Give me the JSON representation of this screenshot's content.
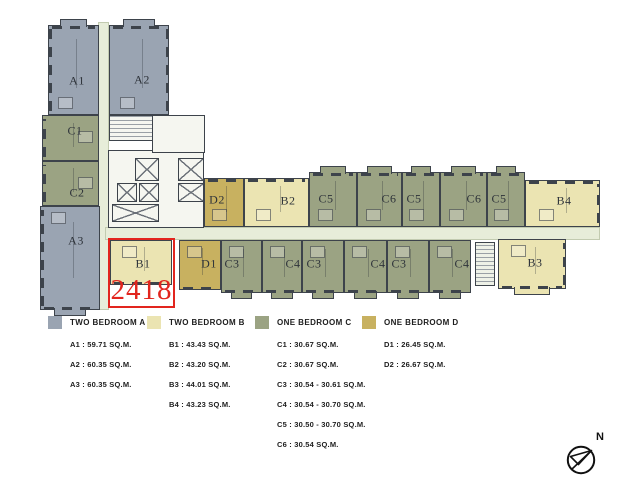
{
  "plan": {
    "wall_color": "#3d434b",
    "unit_colors": {
      "A": "#9aa4b2",
      "B": "#ebe4b2",
      "C": "#9ba383",
      "D": "#c8b160"
    },
    "corridor_color": "#e7edd9",
    "highlight": {
      "number": "2418",
      "unit": "B1",
      "color": "#e2251e",
      "x": 108,
      "y": 238,
      "w": 67,
      "h": 70
    },
    "units": [
      {
        "label": "A1",
        "type": "A",
        "x": 48,
        "y": 25,
        "w": 51,
        "h": 90,
        "lx": 76,
        "ly": 80,
        "facades": "top left",
        "tabs": "top"
      },
      {
        "label": "A2",
        "type": "A",
        "x": 109,
        "y": 25,
        "w": 60,
        "h": 90,
        "lx": 141,
        "ly": 79,
        "facades": "top right",
        "tabs": "top"
      },
      {
        "label": "C1",
        "type": "C",
        "x": 42,
        "y": 115,
        "w": 57,
        "h": 46,
        "lx": 74,
        "ly": 130,
        "facades": "left",
        "tabs": ""
      },
      {
        "label": "C2",
        "type": "C",
        "x": 42,
        "y": 161,
        "w": 57,
        "h": 45,
        "lx": 76,
        "ly": 192,
        "facades": "left",
        "tabs": ""
      },
      {
        "label": "A3",
        "type": "A",
        "x": 40,
        "y": 206,
        "w": 60,
        "h": 104,
        "lx": 75,
        "ly": 240,
        "facades": "left bottom",
        "tabs": "bottom"
      },
      {
        "label": "D2",
        "type": "D",
        "x": 204,
        "y": 178,
        "w": 40,
        "h": 49,
        "lx": 216,
        "ly": 199,
        "facades": "top",
        "tabs": ""
      },
      {
        "label": "B2",
        "type": "B",
        "x": 244,
        "y": 178,
        "w": 65,
        "h": 49,
        "lx": 287,
        "ly": 200,
        "facades": "top",
        "tabs": ""
      },
      {
        "label": "C5",
        "type": "C",
        "x": 309,
        "y": 172,
        "w": 48,
        "h": 55,
        "lx": 325,
        "ly": 198,
        "facades": "top",
        "tabs": "top"
      },
      {
        "label": "C6",
        "type": "C",
        "x": 357,
        "y": 172,
        "w": 45,
        "h": 55,
        "lx": 388,
        "ly": 198,
        "facades": "top",
        "tabs": "top"
      },
      {
        "label": "C5",
        "type": "C",
        "x": 402,
        "y": 172,
        "w": 38,
        "h": 55,
        "lx": 413,
        "ly": 198,
        "facades": "top",
        "tabs": "top"
      },
      {
        "label": "C6",
        "type": "C",
        "x": 440,
        "y": 172,
        "w": 47,
        "h": 55,
        "lx": 473,
        "ly": 198,
        "facades": "top",
        "tabs": "top"
      },
      {
        "label": "C5",
        "type": "C",
        "x": 487,
        "y": 172,
        "w": 38,
        "h": 55,
        "lx": 498,
        "ly": 198,
        "facades": "top",
        "tabs": "top"
      },
      {
        "label": "B4",
        "type": "B",
        "x": 525,
        "y": 180,
        "w": 75,
        "h": 47,
        "lx": 563,
        "ly": 200,
        "facades": "top right",
        "tabs": ""
      },
      {
        "label": "B1",
        "type": "B",
        "x": 110,
        "y": 240,
        "w": 62,
        "h": 45,
        "lx": 142,
        "ly": 263,
        "facades": "bottom",
        "tabs": ""
      },
      {
        "label": "D1",
        "type": "D",
        "x": 179,
        "y": 240,
        "w": 42,
        "h": 50,
        "lx": 208,
        "ly": 263,
        "facades": "bottom",
        "tabs": ""
      },
      {
        "label": "C3",
        "type": "C",
        "x": 221,
        "y": 240,
        "w": 41,
        "h": 53,
        "lx": 231,
        "ly": 263,
        "facades": "bottom",
        "tabs": "bottom"
      },
      {
        "label": "C4",
        "type": "C",
        "x": 262,
        "y": 240,
        "w": 40,
        "h": 53,
        "lx": 292,
        "ly": 263,
        "facades": "bottom",
        "tabs": "bottom"
      },
      {
        "label": "C3",
        "type": "C",
        "x": 302,
        "y": 240,
        "w": 42,
        "h": 53,
        "lx": 313,
        "ly": 263,
        "facades": "bottom",
        "tabs": "bottom"
      },
      {
        "label": "C4",
        "type": "C",
        "x": 344,
        "y": 240,
        "w": 43,
        "h": 53,
        "lx": 377,
        "ly": 263,
        "facades": "bottom",
        "tabs": "bottom"
      },
      {
        "label": "C3",
        "type": "C",
        "x": 387,
        "y": 240,
        "w": 42,
        "h": 53,
        "lx": 398,
        "ly": 263,
        "facades": "bottom",
        "tabs": "bottom"
      },
      {
        "label": "C4",
        "type": "C",
        "x": 429,
        "y": 240,
        "w": 42,
        "h": 53,
        "lx": 461,
        "ly": 263,
        "facades": "bottom",
        "tabs": "bottom"
      },
      {
        "label": "B3",
        "type": "B",
        "x": 498,
        "y": 239,
        "w": 68,
        "h": 50,
        "lx": 534,
        "ly": 262,
        "facades": "bottom right",
        "tabs": "bottom"
      }
    ],
    "corridors": [
      {
        "x": 98,
        "y": 22,
        "w": 11,
        "h": 288
      },
      {
        "x": 105,
        "y": 227,
        "w": 495,
        "h": 13
      }
    ],
    "core": {
      "x": 108,
      "y": 150,
      "w": 96,
      "h": 78
    },
    "service_rooms": [
      {
        "x": 109,
        "y": 115,
        "w": 44,
        "h": 26,
        "stairs": true
      },
      {
        "x": 152,
        "y": 115,
        "w": 53,
        "h": 38,
        "stairs": false
      }
    ],
    "elevators": [
      {
        "x": 135,
        "y": 158,
        "w": 24,
        "h": 23
      },
      {
        "x": 117,
        "y": 183,
        "w": 20,
        "h": 19
      },
      {
        "x": 139,
        "y": 183,
        "w": 20,
        "h": 19
      },
      {
        "x": 178,
        "y": 158,
        "w": 26,
        "h": 23
      },
      {
        "x": 178,
        "y": 183,
        "w": 26,
        "h": 19
      },
      {
        "x": 112,
        "y": 204,
        "w": 47,
        "h": 18
      }
    ],
    "stairs": [
      {
        "x": 475,
        "y": 242,
        "w": 20,
        "h": 44
      }
    ]
  },
  "legend": {
    "top": 316,
    "groups": [
      {
        "name": "TWO BEDROOM A",
        "color": "#9aa4b2",
        "x": 48,
        "items": [
          "A1 : 59.71 SQ.M.",
          "A2 : 60.35 SQ.M.",
          "A3 : 60.35 SQ.M."
        ]
      },
      {
        "name": "TWO BEDROOM B",
        "color": "#ebe4b2",
        "x": 147,
        "items": [
          "B1 : 43.43 SQ.M.",
          "B2 : 43.20 SQ.M.",
          "B3 : 44.01 SQ.M.",
          "B4 : 43.23 SQ.M."
        ]
      },
      {
        "name": "ONE BEDROOM C",
        "color": "#9ba383",
        "x": 255,
        "items": [
          "C1 : 30.67 SQ.M.",
          "C2 : 30.67 SQ.M.",
          "C3 : 30.54 - 30.61 SQ.M.",
          "C4 : 30.54 - 30.70 SQ.M.",
          "C5 : 30.50 - 30.70 SQ.M.",
          "C6 : 30.54 SQ.M."
        ]
      },
      {
        "name": "ONE BEDROOM D",
        "color": "#c8b160",
        "x": 362,
        "items": [
          "D1 : 26.45 SQ.M.",
          "D2 : 26.67 SQ.M."
        ]
      }
    ]
  },
  "compass": {
    "label": "N"
  }
}
